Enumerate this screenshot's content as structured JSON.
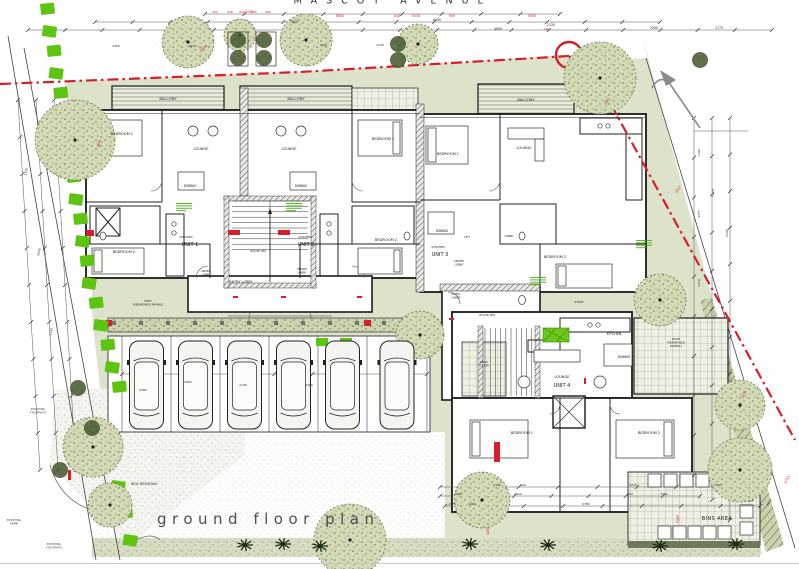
{
  "page": {
    "street_name": "MASCOT AVENUE",
    "plan_title": "ground floor plan",
    "drawing_type": "architectural ground floor site plan"
  },
  "colors": {
    "boundary_red": "#d61f2c",
    "hedge_green": "#5ec412",
    "annotation_green": "#3fae00",
    "landscape_olive": "#dde2cb",
    "wall_black": "#1a1a1a",
    "title_grey": "#4e4e4e"
  },
  "units": [
    "UNIT 1",
    "UNIT 2",
    "UNIT 3",
    "UNIT 4"
  ],
  "areas": [
    "BALCONY",
    "ENTRY LOBBY",
    "SMOKE LOBBY",
    "EQUIP. RM",
    "BINS AREA",
    "NEW DRIVEWAY",
    "EXISTING FOOTPATH",
    "EXISTING KERB",
    "PATH (PERMEABLE PAVING)",
    "PATIO (PERMEABLE PAVING)",
    "PATIO (TILED)"
  ],
  "labels": [
    {
      "t": "MASCOT AVENUE",
      "x": 393,
      "y": 3.5,
      "fs": 9.5,
      "ls": 9,
      "c": "#2f2f2f"
    },
    {
      "t": "ground floor plan",
      "x": 157,
      "y": 524,
      "fs": 15,
      "ls": 5.5,
      "c": "#4e4e4e",
      "a": "start"
    },
    {
      "t": "BINS AREA",
      "x": 717,
      "y": 520,
      "fs": 4.8,
      "ls": 0.5
    },
    {
      "t": "NEW DRIVEWAY",
      "x": 144,
      "y": 485,
      "fs": 3.4,
      "c": "#3a3a3a"
    },
    {
      "t": [
        "EXISTING",
        "FOOTPATH"
      ],
      "x": 38,
      "y": 410,
      "fs": 3,
      "c": "#3a3a3a"
    },
    {
      "t": [
        "EXISTING",
        "KERB"
      ],
      "x": 14,
      "y": 521,
      "fs": 3,
      "c": "#3a3a3a"
    },
    {
      "t": [
        "EXISTING",
        "FOOTPATH"
      ],
      "x": 54,
      "y": 545,
      "fs": 3,
      "c": "#3a3a3a"
    },
    {
      "t": "BALCONY",
      "x": 168,
      "y": 100,
      "fs": 3.6
    },
    {
      "t": "BALCONY",
      "x": 296,
      "y": 100,
      "fs": 3.6
    },
    {
      "t": "BALCONY",
      "x": 526,
      "y": 101,
      "fs": 3.6
    },
    {
      "t": "BEDROOM 1",
      "x": 122,
      "y": 135,
      "fs": 3.6
    },
    {
      "t": "LOUNGE",
      "x": 201,
      "y": 150,
      "fs": 3.6
    },
    {
      "t": "DINING",
      "x": 190,
      "y": 187,
      "fs": 3.4
    },
    {
      "t": "KITCHEN",
      "x": 186,
      "y": 238,
      "fs": 3
    },
    {
      "t": "UNIT 1",
      "x": 190,
      "y": 246,
      "fs": 5
    },
    {
      "t": "BEDROOM 2",
      "x": 124,
      "y": 253,
      "fs": 3.6
    },
    {
      "t": "LOUNGE",
      "x": 289,
      "y": 150,
      "fs": 3.6
    },
    {
      "t": "DINING",
      "x": 301,
      "y": 187,
      "fs": 3.4
    },
    {
      "t": "KITCHEN",
      "x": 305,
      "y": 238,
      "fs": 3
    },
    {
      "t": "UNIT 2",
      "x": 306,
      "y": 246,
      "fs": 5
    },
    {
      "t": "BEDROOM 1",
      "x": 383,
      "y": 140,
      "fs": 3.6
    },
    {
      "t": "BEDROOM 2",
      "x": 386,
      "y": 241,
      "fs": 3.6
    },
    {
      "t": "BEDROOM 1",
      "x": 448,
      "y": 155,
      "fs": 3.6
    },
    {
      "t": "LOUNGE",
      "x": 524,
      "y": 149,
      "fs": 3.6
    },
    {
      "t": "DINING",
      "x": 442,
      "y": 232,
      "fs": 3.4
    },
    {
      "t": "KITCHEN",
      "x": 438,
      "y": 248,
      "fs": 3
    },
    {
      "t": "UNIT 3",
      "x": 440,
      "y": 256,
      "fs": 5
    },
    {
      "t": "BEDROOM 2",
      "x": 555,
      "y": 258,
      "fs": 3.6
    },
    {
      "t": "LOBBY",
      "x": 509,
      "y": 237,
      "fs": 2.8
    },
    {
      "t": "LIFT",
      "x": 467,
      "y": 238,
      "fs": 2.8
    },
    {
      "t": "EQUIP. RM",
      "x": 258,
      "y": 252,
      "fs": 3
    },
    {
      "t": "ENTRY LOBBY",
      "x": 241,
      "y": 283,
      "fs": 3.4
    },
    {
      "t": [
        "SMOKE",
        "LOBBY"
      ],
      "x": 206,
      "y": 272,
      "fs": 2.8
    },
    {
      "t": [
        "SMOKE",
        "LOBBY"
      ],
      "x": 302,
      "y": 270,
      "fs": 2.8
    },
    {
      "t": [
        "SMOKE",
        "LOBBY"
      ],
      "x": 459,
      "y": 262,
      "fs": 2.8
    },
    {
      "t": [
        "ENTRY",
        "LOBBY"
      ],
      "x": 456,
      "y": 295,
      "fs": 2.8
    },
    {
      "t": "EQUIP. RM",
      "x": 487,
      "y": 316,
      "fs": 3
    },
    {
      "t": "KITCHEN",
      "x": 614,
      "y": 335,
      "fs": 3.4
    },
    {
      "t": "DINING",
      "x": 624,
      "y": 358,
      "fs": 3.4
    },
    {
      "t": "LOUNGE",
      "x": 562,
      "y": 378,
      "fs": 3.6
    },
    {
      "t": "UNIT 4",
      "x": 562,
      "y": 387,
      "fs": 5
    },
    {
      "t": "BEDROOM 1",
      "x": 522,
      "y": 434,
      "fs": 3.6
    },
    {
      "t": "BEDROOM 2",
      "x": 649,
      "y": 434,
      "fs": 3.6
    },
    {
      "t": "STORE",
      "x": 579,
      "y": 303,
      "fs": 2.6
    },
    {
      "t": [
        "PATIO",
        "(PERMEABLE",
        "PAVING)"
      ],
      "x": 676,
      "y": 340,
      "fs": 2.8
    },
    {
      "t": [
        "PATIO",
        "(TILED)"
      ],
      "x": 484,
      "y": 363,
      "fs": 2.8
    },
    {
      "t": [
        "PATH",
        "(PERMEABLE PAVING)"
      ],
      "x": 148,
      "y": 302,
      "fs": 2.8
    },
    {
      "t": "1950",
      "x": 204,
      "y": 49,
      "fs": 3.4,
      "c": "#d61f2c",
      "r": -38
    },
    {
      "t": "2700",
      "x": 249,
      "y": 13,
      "fs": 3.4,
      "c": "#d61f2c"
    },
    {
      "t": "900",
      "x": 215,
      "y": 13,
      "fs": 2.9,
      "c": "#d61f2c"
    },
    {
      "t": "640",
      "x": 230,
      "y": 13,
      "fs": 2.9,
      "c": "#d61f2c"
    },
    {
      "t": "640",
      "x": 242,
      "y": 13,
      "fs": 2.9,
      "c": "#d61f2c"
    },
    {
      "t": "600",
      "x": 254,
      "y": 13,
      "fs": 2.9,
      "c": "#d61f2c"
    },
    {
      "t": "900",
      "x": 268,
      "y": 13,
      "fs": 2.9,
      "c": "#d61f2c"
    },
    {
      "t": "6850",
      "x": 340,
      "y": 17,
      "fs": 3.4,
      "c": "#d61f2c"
    },
    {
      "t": "640",
      "x": 397,
      "y": 17,
      "fs": 3.2,
      "c": "#d61f2c"
    },
    {
      "t": "5030",
      "x": 416,
      "y": 17,
      "fs": 3.4,
      "c": "#d61f2c"
    },
    {
      "t": "900",
      "x": 452,
      "y": 17,
      "fs": 3.2,
      "c": "#d61f2c"
    },
    {
      "t": "5500",
      "x": 532,
      "y": 17,
      "fs": 3.4,
      "c": "#d61f2c"
    },
    {
      "t": "140",
      "x": 546,
      "y": 30,
      "fs": 2.9,
      "c": "#d61f2c"
    },
    {
      "t": "1950",
      "x": 100,
      "y": 144,
      "fs": 3.2,
      "c": "#d61f2c",
      "r": -80
    },
    {
      "t": "2385",
      "x": 608,
      "y": 102,
      "fs": 3.2,
      "c": "#d61f2c",
      "r": -60
    },
    {
      "t": "3017",
      "x": 679,
      "y": 190,
      "fs": 3.2,
      "c": "#d61f2c",
      "r": -62
    },
    {
      "t": "3070",
      "x": 745,
      "y": 395,
      "fs": 3.2,
      "c": "#d61f2c",
      "r": -62
    },
    {
      "t": "6783",
      "x": 788,
      "y": 480,
      "fs": 3.2,
      "c": "#d61f2c",
      "r": -62
    },
    {
      "t": "4280",
      "x": 489,
      "y": 531,
      "fs": 3.2,
      "c": "#d61f2c",
      "r": -90
    },
    {
      "t": "5080",
      "x": 679,
      "y": 519,
      "fs": 3.2,
      "c": "#d61f2c",
      "r": -90
    },
    {
      "t": "7800",
      "x": 294,
      "y": 23,
      "fs": 3.2,
      "c": "#2b2b2b"
    },
    {
      "t": "6390",
      "x": 437,
      "y": 21,
      "fs": 3.2,
      "c": "#2b2b2b"
    },
    {
      "t": "4650",
      "x": 498,
      "y": 30,
      "fs": 3.2,
      "c": "#2b2b2b"
    },
    {
      "t": "2120",
      "x": 551,
      "y": 26,
      "fs": 3.2,
      "c": "#2b2b2b"
    },
    {
      "t": "3290",
      "x": 654,
      "y": 29,
      "fs": 3.2,
      "c": "#2b2b2b"
    },
    {
      "t": "1775",
      "x": 719,
      "y": 29,
      "fs": 3.2,
      "c": "#2b2b2b"
    },
    {
      "t": "2380",
      "x": 116,
      "y": 47,
      "fs": 2.9,
      "c": "#2b2b2b"
    },
    {
      "t": "1670",
      "x": 192,
      "y": 47,
      "fs": 2.9,
      "c": "#2b2b2b"
    },
    {
      "t": "1590",
      "x": 323,
      "y": 46,
      "fs": 2.9,
      "c": "#2b2b2b"
    },
    {
      "t": "2340",
      "x": 380,
      "y": 46,
      "fs": 2.9,
      "c": "#2b2b2b"
    },
    {
      "t": "1790",
      "x": 700,
      "y": 153,
      "fs": 3,
      "c": "#2b2b2b",
      "r": -90
    },
    {
      "t": "2255",
      "x": 700,
      "y": 214,
      "fs": 3,
      "c": "#2b2b2b",
      "r": -90
    },
    {
      "t": "2430",
      "x": 700,
      "y": 283,
      "fs": 3,
      "c": "#2b2b2b",
      "r": -90
    },
    {
      "t": "5170",
      "x": 714,
      "y": 193,
      "fs": 3,
      "c": "#2b2b2b",
      "r": -90
    },
    {
      "t": "6440",
      "x": 728,
      "y": 233,
      "fs": 3,
      "c": "#2b2b2b",
      "r": -90
    },
    {
      "t": "9997",
      "x": 619,
      "y": 116,
      "fs": 3,
      "c": "#2b2b2b",
      "r": -62
    },
    {
      "t": "4973",
      "x": 770,
      "y": 503,
      "fs": 3,
      "c": "#2b2b2b",
      "r": -62
    },
    {
      "t": "2130",
      "x": 27,
      "y": 172,
      "fs": 3,
      "c": "#2b2b2b",
      "r": -80
    },
    {
      "t": "4040",
      "x": 40,
      "y": 252,
      "fs": 3,
      "c": "#2b2b2b",
      "r": -80
    },
    {
      "t": "4540",
      "x": 52,
      "y": 332,
      "fs": 3,
      "c": "#2b2b2b",
      "r": -80
    },
    {
      "t": "2120",
      "x": 497,
      "y": 486,
      "fs": 3,
      "c": "#2b2b2b"
    },
    {
      "t": "990",
      "x": 523,
      "y": 486,
      "fs": 3,
      "c": "#2b2b2b"
    },
    {
      "t": "4215",
      "x": 633,
      "y": 486,
      "fs": 3,
      "c": "#2b2b2b"
    },
    {
      "t": "1265",
      "x": 718,
      "y": 486,
      "fs": 3,
      "c": "#2b2b2b"
    },
    {
      "t": "1080",
      "x": 458,
      "y": 495,
      "fs": 3,
      "c": "#2b2b2b"
    },
    {
      "t": "2020",
      "x": 518,
      "y": 495,
      "fs": 3,
      "c": "#2b2b2b"
    },
    {
      "t": "890",
      "x": 630,
      "y": 495,
      "fs": 3,
      "c": "#2b2b2b"
    },
    {
      "t": "1500",
      "x": 664,
      "y": 495,
      "fs": 3,
      "c": "#2b2b2b"
    },
    {
      "t": "1570",
      "x": 452,
      "y": 505,
      "fs": 3,
      "c": "#2b2b2b"
    },
    {
      "t": "1060",
      "x": 472,
      "y": 505,
      "fs": 3,
      "c": "#2b2b2b"
    },
    {
      "t": "9780",
      "x": 586,
      "y": 505,
      "fs": 3,
      "c": "#2b2b2b"
    },
    {
      "t": "5280",
      "x": 143,
      "y": 391,
      "fs": 3,
      "c": "#2b2b2b"
    },
    {
      "t": "2600",
      "x": 188,
      "y": 383,
      "fs": 3,
      "c": "#2b2b2b"
    },
    {
      "t": "2130",
      "x": 243,
      "y": 386,
      "fs": 3,
      "c": "#2b2b2b"
    },
    {
      "t": "2400",
      "x": 309,
      "y": 386,
      "fs": 3,
      "c": "#2b2b2b"
    }
  ]
}
